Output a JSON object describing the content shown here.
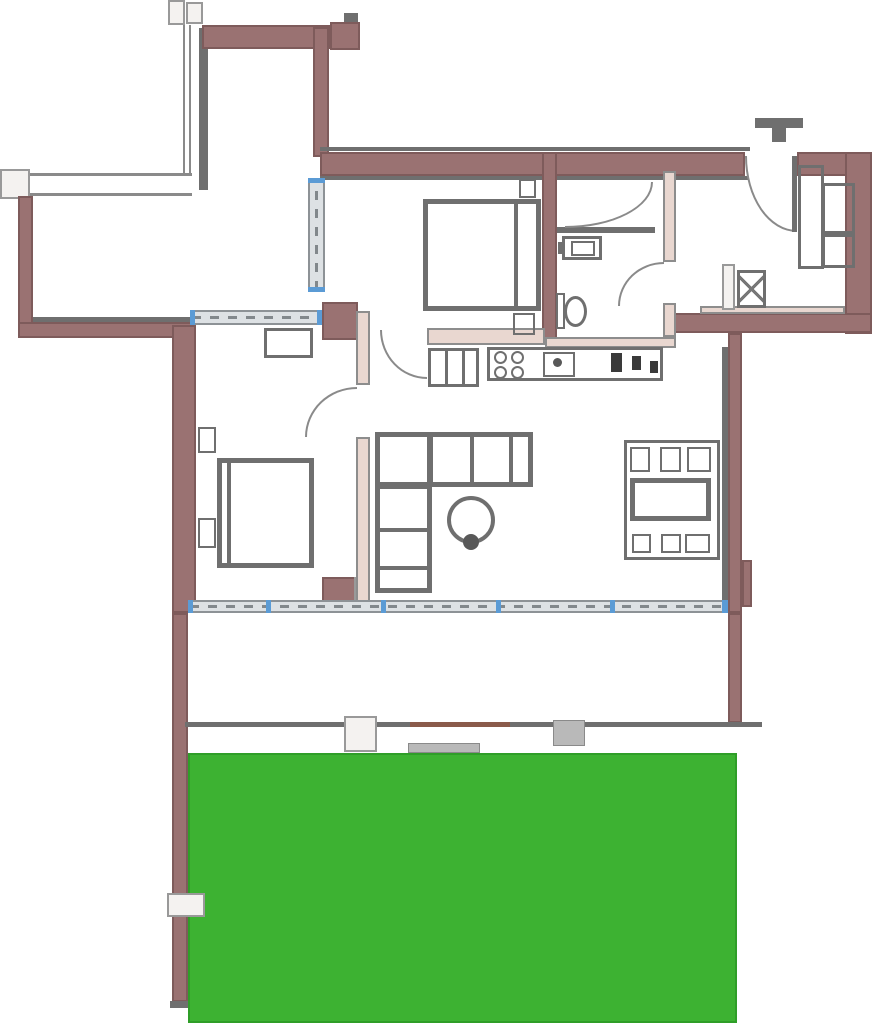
{
  "canvas": {
    "width": 872,
    "height": 1029
  },
  "colors": {
    "bg": "#ffffff",
    "wall": "#9a7272",
    "wall_edge": "#7e5b5b",
    "partition": "#e9d7d0",
    "partition_edge": "#8d8d8d",
    "gray": "#6f6f6f",
    "dark": "#3a3a3a",
    "window_fill": "#dde1e4",
    "window_edge": "#8d9296",
    "window_dash": "#82888c",
    "tick": "#5b9bd5",
    "step_fill": "#f4f2f0",
    "step_edge": "#999999",
    "gray_step": "#b9b9b9",
    "lawn": "#3db232",
    "lawn_edge": "#2f9e28",
    "accent_brown": "#8a5a4a"
  },
  "elements": [
    {
      "name": "north-gate-leaf-1",
      "type": "step",
      "x": 168,
      "y": 0,
      "w": 17,
      "h": 25
    },
    {
      "name": "north-gate-leaf-2",
      "type": "step",
      "x": 186,
      "y": 2,
      "w": 17,
      "h": 22
    },
    {
      "name": "west-fence",
      "type": "fence-v",
      "x": 183,
      "y": 25,
      "w": 8,
      "h": 150
    },
    {
      "name": "courtyard-north-gray-wall",
      "type": "gray-wall",
      "x": 199,
      "y": 28,
      "w": 9,
      "h": 162
    },
    {
      "name": "north-fence-walkway",
      "type": "fence-h",
      "x": 0,
      "y": 173,
      "w": 192,
      "h": 23
    },
    {
      "name": "west-gate",
      "type": "step",
      "x": 0,
      "y": 169,
      "w": 30,
      "h": 30
    },
    {
      "name": "wall-top-northwest",
      "type": "wall",
      "x": 202,
      "y": 25,
      "w": 128,
      "h": 24
    },
    {
      "name": "pillar-northwest",
      "type": "wall",
      "x": 330,
      "y": 22,
      "w": 30,
      "h": 28
    },
    {
      "name": "pillar-northwest-cap",
      "type": "gray-wall",
      "x": 344,
      "y": 13,
      "w": 14,
      "h": 9
    },
    {
      "name": "wall-west-upper",
      "type": "wall",
      "x": 313,
      "y": 27,
      "w": 16,
      "h": 130
    },
    {
      "name": "line-top-outer",
      "type": "line",
      "x": 320,
      "y": 147,
      "w": 430,
      "h": 4
    },
    {
      "name": "wall-top-main",
      "type": "wall",
      "x": 320,
      "y": 152,
      "w": 425,
      "h": 24
    },
    {
      "name": "line-top-inner",
      "type": "line",
      "x": 320,
      "y": 176,
      "w": 428,
      "h": 4
    },
    {
      "name": "wall-top-entry-right",
      "type": "wall",
      "x": 797,
      "y": 152,
      "w": 75,
      "h": 24
    },
    {
      "name": "wall-right-upper",
      "type": "wall",
      "x": 845,
      "y": 152,
      "w": 27,
      "h": 182
    },
    {
      "name": "wall-hall-south",
      "type": "wall",
      "x": 663,
      "y": 313,
      "w": 209,
      "h": 20
    },
    {
      "name": "lining-hall-south",
      "type": "partition",
      "x": 700,
      "y": 306,
      "w": 145,
      "h": 8
    },
    {
      "name": "wall-living-east",
      "type": "wall",
      "x": 728,
      "y": 333,
      "w": 14,
      "h": 280
    },
    {
      "name": "line-living-east",
      "type": "line",
      "x": 722,
      "y": 347,
      "w": 6,
      "h": 256
    },
    {
      "name": "pier-living-east",
      "type": "wall",
      "x": 742,
      "y": 560,
      "w": 10,
      "h": 47
    },
    {
      "name": "wall-balcony-east",
      "type": "wall",
      "x": 728,
      "y": 613,
      "w": 14,
      "h": 110
    },
    {
      "name": "wall-bed2-bath",
      "type": "wall",
      "x": 542,
      "y": 152,
      "w": 15,
      "h": 190
    },
    {
      "name": "wall-court-west",
      "type": "wall",
      "x": 18,
      "y": 196,
      "w": 15,
      "h": 132
    },
    {
      "name": "wall-court-south",
      "type": "wall",
      "x": 18,
      "y": 322,
      "w": 174,
      "h": 16
    },
    {
      "name": "line-court-south",
      "type": "line",
      "x": 33,
      "y": 317,
      "w": 159,
      "h": 5
    },
    {
      "name": "pillar-bed1-north",
      "type": "wall",
      "x": 322,
      "y": 302,
      "w": 36,
      "h": 38
    },
    {
      "name": "wall-bed1-west",
      "type": "wall",
      "x": 172,
      "y": 325,
      "w": 24,
      "h": 288
    },
    {
      "name": "wall-garden-west",
      "type": "wall",
      "x": 172,
      "y": 613,
      "w": 16,
      "h": 389
    },
    {
      "name": "wall-garden-west-end",
      "type": "gray-wall",
      "x": 170,
      "y": 1001,
      "w": 34,
      "h": 7
    },
    {
      "name": "pier-window-middle",
      "type": "wall",
      "x": 322,
      "y": 577,
      "w": 36,
      "h": 29
    },
    {
      "name": "sill-window-middle",
      "type": "step",
      "x": 354,
      "y": 577,
      "w": 14,
      "h": 29
    },
    {
      "name": "partition-bed1-east-upper",
      "type": "partition",
      "x": 356,
      "y": 311,
      "w": 14,
      "h": 74
    },
    {
      "name": "partition-bed1-east-lower",
      "type": "partition",
      "x": 356,
      "y": 437,
      "w": 14,
      "h": 176
    },
    {
      "name": "partition-bed2-south",
      "type": "partition",
      "x": 427,
      "y": 328,
      "w": 118,
      "h": 17
    },
    {
      "name": "partition-bath-east-upper",
      "type": "partition",
      "x": 663,
      "y": 171,
      "w": 13,
      "h": 91
    },
    {
      "name": "partition-bath-east-lower",
      "type": "partition",
      "x": 663,
      "y": 303,
      "w": 13,
      "h": 34
    },
    {
      "name": "partition-bath-south",
      "type": "partition",
      "x": 545,
      "y": 337,
      "w": 131,
      "h": 11
    },
    {
      "name": "divider-bathroom",
      "type": "gray-wall",
      "x": 557,
      "y": 227,
      "w": 98,
      "h": 6
    },
    {
      "name": "window-bed2-west",
      "type": "window-v",
      "x": 308,
      "y": 178,
      "w": 17,
      "h": 114
    },
    {
      "name": "window-tick",
      "type": "tick",
      "x": 308,
      "y": 178,
      "w": 17,
      "h": 5
    },
    {
      "name": "window-tick",
      "type": "tick",
      "x": 308,
      "y": 287,
      "w": 17,
      "h": 5
    },
    {
      "name": "window-bed1-north",
      "type": "window-h",
      "x": 190,
      "y": 310,
      "w": 132,
      "h": 15
    },
    {
      "name": "window-tick",
      "type": "tick",
      "x": 190,
      "y": 310,
      "w": 5,
      "h": 15
    },
    {
      "name": "window-tick",
      "type": "tick",
      "x": 317,
      "y": 310,
      "w": 5,
      "h": 15
    },
    {
      "name": "window-south-glazing",
      "type": "window-h",
      "x": 188,
      "y": 600,
      "w": 540,
      "h": 13
    },
    {
      "name": "window-tick",
      "type": "tick",
      "x": 188,
      "y": 600,
      "w": 5,
      "h": 13
    },
    {
      "name": "window-tick",
      "type": "tick",
      "x": 266,
      "y": 600,
      "w": 5,
      "h": 13
    },
    {
      "name": "window-tick",
      "type": "tick",
      "x": 381,
      "y": 600,
      "w": 5,
      "h": 13
    },
    {
      "name": "window-tick",
      "type": "tick",
      "x": 496,
      "y": 600,
      "w": 5,
      "h": 13
    },
    {
      "name": "window-tick",
      "type": "tick",
      "x": 610,
      "y": 600,
      "w": 5,
      "h": 13
    },
    {
      "name": "window-tick",
      "type": "tick",
      "x": 722,
      "y": 600,
      "w": 6,
      "h": 13
    },
    {
      "name": "balcony-edge",
      "type": "line",
      "x": 185,
      "y": 722,
      "w": 577,
      "h": 5
    },
    {
      "name": "balcony-edge-accent",
      "type": "brown-line",
      "x": 410,
      "y": 722,
      "w": 100,
      "h": 5
    },
    {
      "name": "garden-lawn",
      "type": "lawn",
      "x": 188,
      "y": 753,
      "w": 549,
      "h": 270
    },
    {
      "name": "garden-step-white",
      "type": "step",
      "x": 344,
      "y": 716,
      "w": 33,
      "h": 36
    },
    {
      "name": "garden-step-gray",
      "type": "gray-step",
      "x": 553,
      "y": 720,
      "w": 32,
      "h": 26
    },
    {
      "name": "garden-path",
      "type": "gray-step",
      "x": 408,
      "y": 743,
      "w": 72,
      "h": 10
    },
    {
      "name": "garden-gate",
      "type": "step",
      "x": 167,
      "y": 893,
      "w": 38,
      "h": 24
    },
    {
      "name": "entry-doormat",
      "type": "gray-wall",
      "x": 755,
      "y": 118,
      "w": 48,
      "h": 10
    },
    {
      "name": "entry-doormat-stem",
      "type": "gray-wall",
      "x": 772,
      "y": 128,
      "w": 14,
      "h": 14
    },
    {
      "name": "entrance-door-arc",
      "type": "arc",
      "hinge": "tr",
      "x": 745,
      "y": 156,
      "w": 52,
      "h": 76
    },
    {
      "name": "entrance-door-leaf",
      "type": "line",
      "x": 792,
      "y": 156,
      "w": 5,
      "h": 76
    },
    {
      "name": "hall-closet",
      "type": "outline-thin",
      "x": 798,
      "y": 165,
      "w": 26,
      "h": 104
    },
    {
      "name": "hall-closet-box-1",
      "type": "outline-thin",
      "x": 822,
      "y": 183,
      "w": 33,
      "h": 51
    },
    {
      "name": "hall-closet-box-2",
      "type": "outline-thin",
      "x": 822,
      "y": 234,
      "w": 33,
      "h": 34
    },
    {
      "name": "hall-radiator",
      "type": "step",
      "x": 722,
      "y": 264,
      "w": 13,
      "h": 46
    },
    {
      "name": "washing-machine",
      "type": "x-box",
      "x": 737,
      "y": 270,
      "w": 29,
      "h": 38
    },
    {
      "name": "bathroom-door-upper-arc",
      "type": "arc",
      "hinge": "tl",
      "x": 565,
      "y": 182,
      "w": 88,
      "h": 46
    },
    {
      "name": "bathroom-sink",
      "type": "outline-thin",
      "x": 562,
      "y": 236,
      "w": 40,
      "h": 24
    },
    {
      "name": "bathroom-sink-basin",
      "type": "outline2",
      "x": 571,
      "y": 241,
      "w": 24,
      "h": 15
    },
    {
      "name": "bathroom-faucet",
      "type": "gray-wall",
      "x": 558,
      "y": 242,
      "w": 7,
      "h": 12
    },
    {
      "name": "toilet-tank",
      "type": "outline2",
      "x": 556,
      "y": 293,
      "w": 9,
      "h": 36
    },
    {
      "name": "toilet-bowl",
      "type": "ellipse",
      "x": 564,
      "y": 296,
      "w": 23,
      "h": 31
    },
    {
      "name": "bathroom-door-lower-arc",
      "type": "arc",
      "hinge": "br",
      "x": 618,
      "y": 262,
      "w": 46,
      "h": 44
    },
    {
      "name": "bed-2",
      "type": "outline",
      "x": 423,
      "y": 199,
      "w": 118,
      "h": 112
    },
    {
      "name": "bed-2-headboard-line",
      "type": "line",
      "x": 514,
      "y": 201,
      "w": 4,
      "h": 108
    },
    {
      "name": "bed-2-nightstand-top",
      "type": "outline2",
      "x": 519,
      "y": 179,
      "w": 17,
      "h": 19
    },
    {
      "name": "bed-2-nightstand-bottom",
      "type": "outline2",
      "x": 513,
      "y": 313,
      "w": 22,
      "h": 22
    },
    {
      "name": "bedroom-2-door-arc",
      "type": "arc",
      "hinge": "tr",
      "x": 380,
      "y": 330,
      "w": 47,
      "h": 49
    },
    {
      "name": "bed-1",
      "type": "outline",
      "x": 217,
      "y": 458,
      "w": 97,
      "h": 110
    },
    {
      "name": "bed-1-pillow-line",
      "type": "line",
      "x": 227,
      "y": 460,
      "w": 4,
      "h": 106
    },
    {
      "name": "bed-1-nightstand-top",
      "type": "outline2",
      "x": 198,
      "y": 427,
      "w": 18,
      "h": 26
    },
    {
      "name": "bed-1-nightstand-bottom",
      "type": "outline2",
      "x": 198,
      "y": 518,
      "w": 18,
      "h": 30
    },
    {
      "name": "bed-1-wardrobe",
      "type": "outline-thin",
      "x": 264,
      "y": 328,
      "w": 49,
      "h": 30
    },
    {
      "name": "bedroom-1-door-arc",
      "type": "arc",
      "hinge": "br",
      "x": 305,
      "y": 387,
      "w": 52,
      "h": 50
    },
    {
      "name": "sofa-top-section",
      "type": "outline",
      "x": 375,
      "y": 432,
      "w": 158,
      "h": 55
    },
    {
      "name": "sofa-left-section",
      "type": "outline",
      "x": 375,
      "y": 432,
      "w": 57,
      "h": 161
    },
    {
      "name": "sofa-cushion-line",
      "type": "line",
      "x": 429,
      "y": 434,
      "w": 4,
      "h": 51
    },
    {
      "name": "sofa-cushion-line",
      "type": "line",
      "x": 470,
      "y": 434,
      "w": 4,
      "h": 51
    },
    {
      "name": "sofa-cushion-line",
      "type": "line",
      "x": 509,
      "y": 434,
      "w": 4,
      "h": 51
    },
    {
      "name": "sofa-cushion-line",
      "type": "line",
      "x": 377,
      "y": 485,
      "w": 53,
      "h": 4
    },
    {
      "name": "sofa-cushion-line",
      "type": "line",
      "x": 377,
      "y": 528,
      "w": 53,
      "h": 4
    },
    {
      "name": "sofa-cushion-line",
      "type": "line",
      "x": 377,
      "y": 566,
      "w": 53,
      "h": 4
    },
    {
      "name": "coffee-table",
      "type": "circle-outline",
      "x": 447,
      "y": 496,
      "w": 48,
      "h": 48
    },
    {
      "name": "coffee-table-plant",
      "type": "circle-fill",
      "x": 463,
      "y": 534,
      "w": 16,
      "h": 16
    },
    {
      "name": "fridge",
      "type": "outline-thin",
      "x": 428,
      "y": 348,
      "w": 51,
      "h": 39
    },
    {
      "name": "fridge-line",
      "type": "line",
      "x": 445,
      "y": 350,
      "w": 3,
      "h": 35
    },
    {
      "name": "fridge-line",
      "type": "line",
      "x": 462,
      "y": 350,
      "w": 3,
      "h": 35
    },
    {
      "name": "kitchen-counter",
      "type": "outline-thin",
      "x": 487,
      "y": 347,
      "w": 176,
      "h": 34
    },
    {
      "name": "stove-burner",
      "type": "circle-outline2",
      "x": 494,
      "y": 351,
      "w": 13,
      "h": 13
    },
    {
      "name": "stove-burner",
      "type": "circle-outline2",
      "x": 511,
      "y": 351,
      "w": 13,
      "h": 13
    },
    {
      "name": "stove-burner",
      "type": "circle-outline2",
      "x": 494,
      "y": 366,
      "w": 13,
      "h": 13
    },
    {
      "name": "stove-burner",
      "type": "circle-outline2",
      "x": 511,
      "y": 366,
      "w": 13,
      "h": 13
    },
    {
      "name": "kitchen-sink",
      "type": "outline2",
      "x": 543,
      "y": 352,
      "w": 32,
      "h": 25
    },
    {
      "name": "kitchen-faucet",
      "type": "circle-fill",
      "x": 553,
      "y": 358,
      "w": 9,
      "h": 9
    },
    {
      "name": "counter-item",
      "type": "dark",
      "x": 611,
      "y": 353,
      "w": 11,
      "h": 19
    },
    {
      "name": "counter-item",
      "type": "dark",
      "x": 632,
      "y": 356,
      "w": 9,
      "h": 14
    },
    {
      "name": "counter-item",
      "type": "dark",
      "x": 650,
      "y": 361,
      "w": 8,
      "h": 12
    },
    {
      "name": "dining-rug",
      "type": "outline-thin",
      "x": 624,
      "y": 440,
      "w": 96,
      "h": 120
    },
    {
      "name": "dining-chair",
      "type": "outline2",
      "x": 630,
      "y": 447,
      "w": 20,
      "h": 25
    },
    {
      "name": "dining-chair",
      "type": "outline2",
      "x": 660,
      "y": 447,
      "w": 21,
      "h": 25
    },
    {
      "name": "dining-chair",
      "type": "outline2",
      "x": 687,
      "y": 447,
      "w": 24,
      "h": 25
    },
    {
      "name": "dining-table",
      "type": "outline",
      "x": 630,
      "y": 478,
      "w": 81,
      "h": 43
    },
    {
      "name": "dining-chair",
      "type": "outline2",
      "x": 632,
      "y": 534,
      "w": 19,
      "h": 19
    },
    {
      "name": "dining-chair",
      "type": "outline2",
      "x": 661,
      "y": 534,
      "w": 20,
      "h": 19
    },
    {
      "name": "dining-chair",
      "type": "outline2",
      "x": 685,
      "y": 534,
      "w": 25,
      "h": 19
    }
  ]
}
